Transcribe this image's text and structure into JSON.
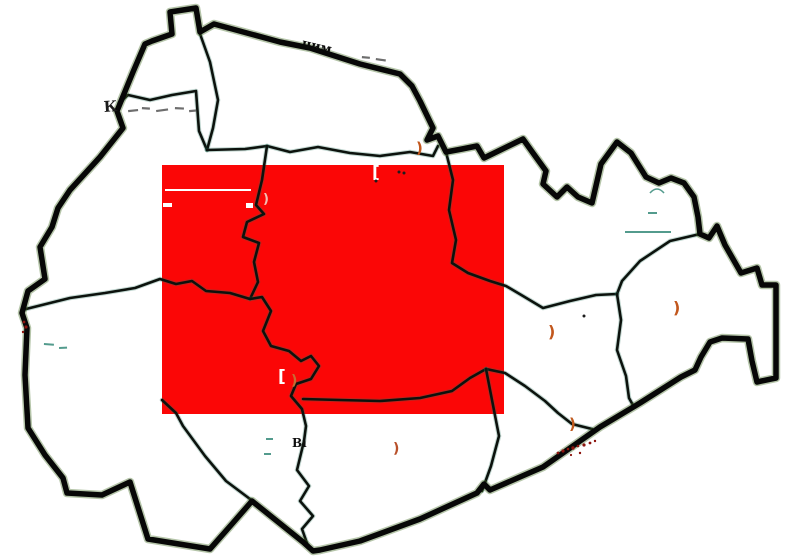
{
  "page": {
    "description": "District boundary map with central red highlighted rectangle and faint remnants of erased place labels"
  },
  "map": {
    "canvas": {
      "w": 800,
      "h": 560,
      "bg": "#ffffff"
    },
    "region_fill": "#ffffff",
    "highlight": {
      "x": 162,
      "y": 165,
      "w": 342,
      "h": 249,
      "color": "#fb0606"
    },
    "stroke": {
      "outer_color": "#070707",
      "outer_width": 5.5,
      "outer_fringe_color": "rgba(70,110,40,0.40)",
      "outer_fringe_width": 8.5,
      "inner_color": "#0c120d",
      "inner_width": 2.6,
      "inner_fringe_color": "rgba(35,110,90,0.28)",
      "inner_fringe_width": 4.6
    },
    "outer_path": "M172,34 L170,12 L196,8 L200,32 L214,24 L280,42 L310,48 L360,64 L400,74 L412,86 L420,101 L433,128 L427,140 L438,136 L446,152 L462,149 L477,146 L484,158 L523,139 L533,153 L546,171 L543,184 L557,197 L567,187 L578,197 L592,203 L601,164 L617,142 L631,153 L646,177 L659,183 L671,178 L684,183 L694,197 L698,217 L700,234 L709,238 L717,226 L725,245 L741,273 L757,268 L762,285 L776,285 L776,378 L757,382 L752,361 L748,339 L722,338 L710,342 L701,357 L695,370 L681,377 L640,403 L600,427 L543,467 L490,490 L484,484 L477,493 L420,519 L360,541 L320,550 L313,551 L303,542 L252,501 L232,524 L210,549 L148,539 L130,482 L102,495 L67,493 L63,478 L45,455 L28,428 L25,375 L27,328 L22,313 L28,291 L45,279 L40,247 L52,227 L58,208 L70,190 L100,157 L123,128 L117,111 L126,89 L133,72 L145,44 L152,41 Z",
    "inner_paths": [
      "M119,103 L128,95 L150,100 L172,95 L196,91 L199,131 L207,150",
      "M199,31 L210,62 L218,100 L213,128 L207,150",
      "M207,150 L245,149 L267,146 L290,152 L318,147 L350,153 L380,156 L410,152 L433,156 L438,146",
      "M267,146 L262,180 L256,205 L264,214 L247,222 L243,237 L259,243 L254,262 L258,282 L250,299",
      "M26,309 L70,298 L105,293 L135,288 L160,279 L176,284 L192,281 L206,291 L230,293 L250,299 L262,297 L271,311 L263,331 L271,346 L289,351 L301,361 L311,356 L319,366 L311,379 L296,384 L291,396 L302,409 L306,426 L304,441 L297,470 L309,486 L300,501 L313,516 L302,529 L308,546",
      "M303,399 L340,400 L380,401 L420,398 L452,391 L470,378 L486,369",
      "M446,152 L453,180 L449,210 L456,240 L452,263 L468,273 L490,281 L506,286 L523,296 L543,308 L570,301 L596,295 L617,294",
      "M700,234 L670,241 L640,261 L622,281 L617,294",
      "M617,294 L621,320 L617,350 L626,376 L629,398 L634,407",
      "M486,369 L505,373 L525,386 L545,401 L558,413 L572,424 L592,429",
      "M486,369 L492,400 L499,436 L491,466 L482,491",
      "M162,400 L176,413 L183,426 L205,456 L226,481 L250,499"
    ],
    "labels": [
      {
        "text": "чим",
        "x": 301,
        "y": 47,
        "rot": 13,
        "size": 13,
        "color": "#0a0a0a"
      },
      {
        "text": "К",
        "x": 104,
        "y": 112,
        "rot": -4,
        "size": 15,
        "color": "#1b1b1b"
      },
      {
        "text": "Ві",
        "x": 292,
        "y": 447,
        "rot": 0,
        "size": 12,
        "color": "#0e0e0e"
      }
    ],
    "arc_marks": [
      {
        "x": 416,
        "y": 153,
        "size": 15,
        "color": "#c2571d"
      },
      {
        "x": 548,
        "y": 337,
        "size": 16,
        "color": "#c2571d"
      },
      {
        "x": 673,
        "y": 313,
        "size": 16,
        "color": "#c2571d"
      },
      {
        "x": 569,
        "y": 429,
        "size": 15,
        "color": "#c05a1e"
      },
      {
        "x": 393,
        "y": 453,
        "size": 14,
        "color": "#b8502a"
      },
      {
        "x": 291,
        "y": 385,
        "size": 14,
        "color": "#c96a33"
      },
      {
        "x": 263,
        "y": 203,
        "size": 13,
        "color": "#f2beb2"
      }
    ],
    "white_bracket_marks": [
      {
        "x": 372,
        "y": 178,
        "size": 17
      },
      {
        "x": 278,
        "y": 382,
        "size": 17
      }
    ],
    "gray_dashes": [
      [
        128,
        110,
        10,
        -6
      ],
      [
        142,
        107,
        8,
        4
      ],
      [
        156,
        110,
        12,
        -8
      ],
      [
        175,
        107,
        9,
        3
      ],
      [
        189,
        110,
        7,
        -5
      ],
      [
        362,
        56,
        8,
        5
      ],
      [
        376,
        58,
        10,
        8
      ]
    ],
    "teal_dashes": [
      [
        625,
        231,
        46,
        0
      ],
      [
        648,
        212,
        9,
        0
      ],
      [
        266,
        438,
        7,
        0
      ],
      [
        264,
        453,
        7,
        0
      ],
      [
        44,
        343,
        10,
        4
      ],
      [
        59,
        347,
        8,
        -3
      ]
    ],
    "teal_arcs": [
      [
        650,
        193,
        14,
        8
      ]
    ],
    "white_rects": [
      [
        165,
        189,
        86,
        2
      ],
      [
        163,
        203,
        9,
        4
      ],
      [
        246,
        203,
        7,
        5
      ]
    ],
    "dark_dots": [
      [
        399,
        172
      ],
      [
        404,
        173
      ],
      [
        376,
        181
      ],
      [
        584,
        316
      ]
    ],
    "red_speckles": [
      [
        558,
        453,
        1.4
      ],
      [
        563,
        451,
        1.6
      ],
      [
        568,
        449,
        1.3
      ],
      [
        573,
        448,
        1.7
      ],
      [
        578,
        446,
        1.3
      ],
      [
        584,
        445,
        1.6
      ],
      [
        590,
        443,
        1.4
      ],
      [
        595,
        441,
        1.2
      ],
      [
        571,
        455,
        1.1
      ],
      [
        580,
        453,
        1.2
      ],
      [
        24,
        322,
        1.4
      ],
      [
        26,
        327,
        1.6
      ],
      [
        23,
        332,
        1.2
      ]
    ],
    "colors": {
      "gray_dash": "#6e6e6e",
      "teal": "rgba(40,130,112,0.8)",
      "dark_dot": "#1d1d1d",
      "speckle": "#8c130d",
      "white": "#ffffff"
    }
  }
}
